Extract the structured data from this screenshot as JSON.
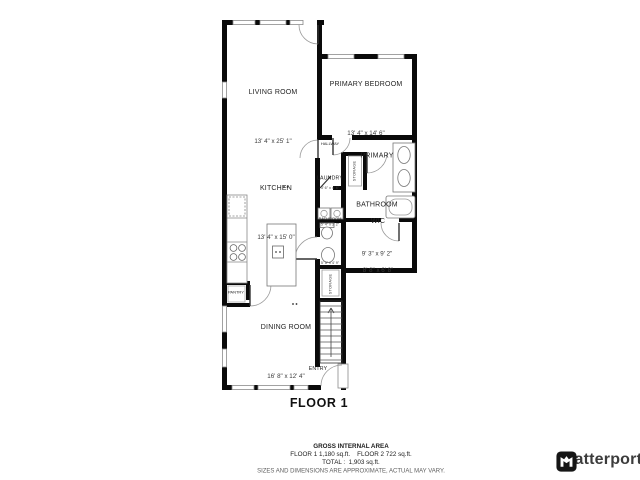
{
  "floor": {
    "title": "FLOOR 1"
  },
  "rooms": {
    "living": {
      "name": "LIVING ROOM",
      "dims": "13' 4\" x 25' 1\""
    },
    "bedroom": {
      "name": "PRIMARY BEDROOM",
      "dims": "13' 4\" x 14' 6\""
    },
    "kitchen": {
      "name": "KITCHEN",
      "dims": "13' 4\" x 15' 0\""
    },
    "hallway": {
      "name": "HALLWAY",
      "dims": "3' 6\" x 4' 6\""
    },
    "storage_upper": {
      "name": "STORAGE"
    },
    "laundry": {
      "name": "LAUNDRY",
      "dims": "5' 4\" x 3' 2\""
    },
    "primary_bath": {
      "name_line1": "PRIMARY",
      "name_line2": "BATHROOM",
      "dims": "9' 3\" x 9' 2\""
    },
    "bathroom2": {
      "name": "BATHROOM",
      "dims": "5' 5\" x 4' 9\""
    },
    "wic": {
      "name": "WIC",
      "dims": "8' 8\" x 6' 8\""
    },
    "storage_lower": {
      "name": "STORAGE"
    },
    "dining": {
      "name": "DINING ROOM",
      "dims": "16' 8\" x 12' 4\""
    },
    "entry": {
      "name": "ENTRY"
    },
    "pantry": {
      "name": "PANTRY"
    }
  },
  "footer": {
    "gross_title": "GROSS INTERNAL AREA",
    "floor_areas": "FLOOR 1 1,180 sq.ft.    FLOOR 2 722 sq.ft.",
    "total": "TOTAL :  1,903 sq.ft.",
    "disclaimer": "SIZES AND DIMENSIONS ARE APPROXIMATE, ACTUAL MAY VARY."
  },
  "branding": {
    "logo_text": "Matterport"
  },
  "colors": {
    "wall": "#0a0a0a",
    "thin_line": "#8a8a8a",
    "label_text": "#232323",
    "logo_text": "#3c3c3c"
  }
}
